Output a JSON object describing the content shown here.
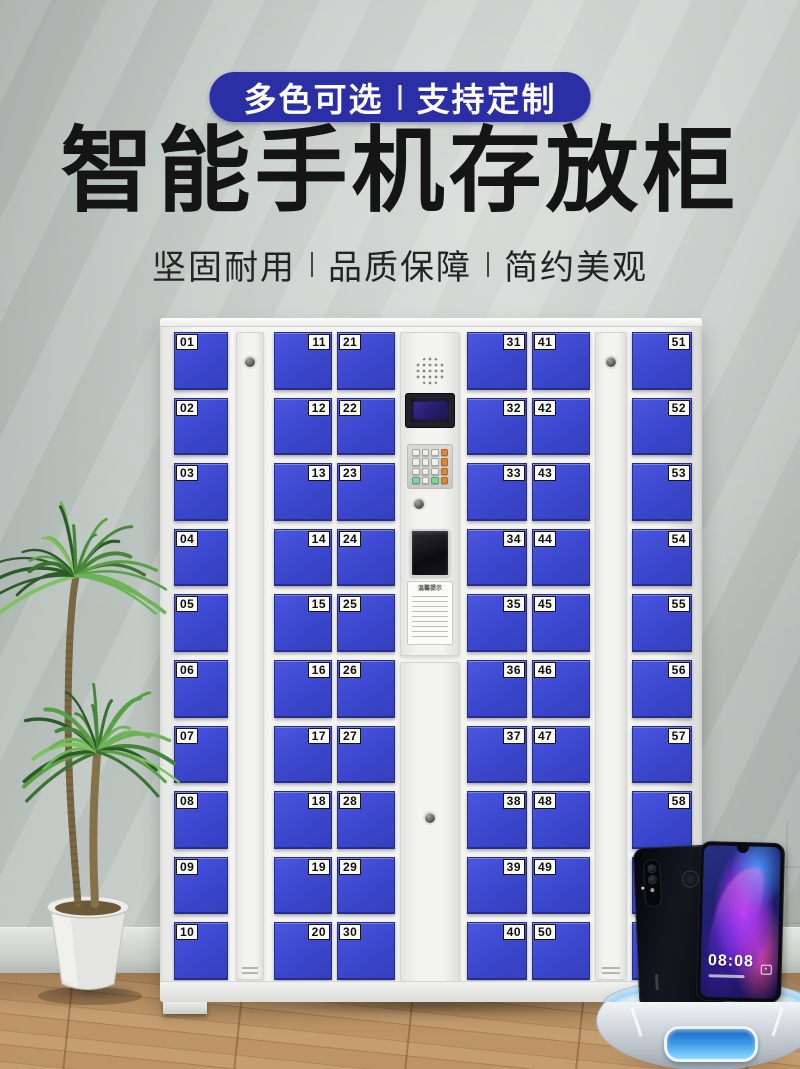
{
  "badge": {
    "left": "多色可选",
    "right": "支持定制"
  },
  "title": "智能手机存放柜",
  "subtitle": {
    "items": [
      "坚固耐用",
      "品质保障",
      "简约美观"
    ]
  },
  "colors": {
    "badge_blue": "#2b2fa6",
    "door_blue": "#3c48cf",
    "cabinet_white": "#f3f3f1"
  },
  "cabinet": {
    "notice_title": "温馨提示",
    "columns": [
      {
        "type": "doors",
        "label_side": "left",
        "numbers": [
          "01",
          "02",
          "03",
          "04",
          "05",
          "06",
          "07",
          "08",
          "09",
          "10"
        ]
      },
      {
        "type": "side-panel"
      },
      {
        "type": "doors",
        "label_side": "right",
        "numbers": [
          "11",
          "12",
          "13",
          "14",
          "15",
          "16",
          "17",
          "18",
          "19",
          "20"
        ]
      },
      {
        "type": "doors",
        "label_side": "left",
        "numbers": [
          "21",
          "22",
          "23",
          "24",
          "25",
          "26",
          "27",
          "28",
          "29",
          "30"
        ]
      },
      {
        "type": "control-panel"
      },
      {
        "type": "doors",
        "label_side": "right",
        "numbers": [
          "31",
          "32",
          "33",
          "34",
          "35",
          "36",
          "37",
          "38",
          "39",
          "40"
        ]
      },
      {
        "type": "doors",
        "label_side": "left",
        "numbers": [
          "41",
          "42",
          "43",
          "44",
          "45",
          "46",
          "47",
          "48",
          "49",
          "50"
        ]
      },
      {
        "type": "side-panel"
      },
      {
        "type": "doors",
        "label_side": "right",
        "numbers": [
          "51",
          "52",
          "53",
          "54",
          "55",
          "56",
          "57",
          "58",
          "",
          ""
        ]
      }
    ]
  },
  "phone": {
    "clock": "08:08"
  }
}
